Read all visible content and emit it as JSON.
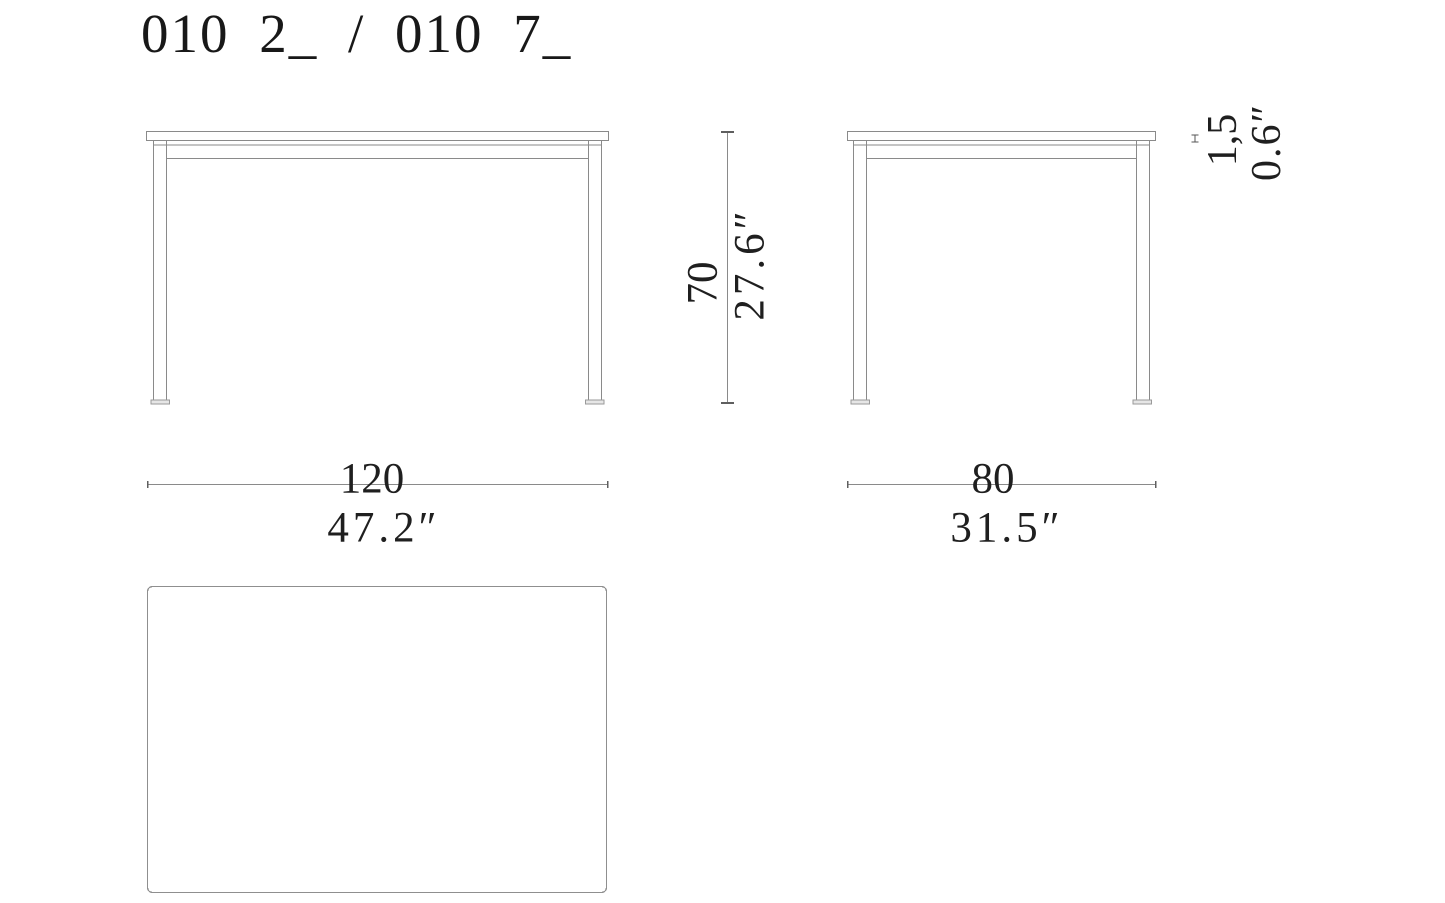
{
  "title": "010 2_ / 010 7_",
  "drawing_type": "furniture-dimension-drawing",
  "views": {
    "front": "front-view",
    "side": "side-view",
    "top": "top-plan-view"
  },
  "dimensions": {
    "height": {
      "cm": "70",
      "inches": "27.6″"
    },
    "width": {
      "cm": "120",
      "inches": "47.2″"
    },
    "depth": {
      "cm": "80",
      "inches": "31.5″"
    },
    "top_thickness": {
      "cm": "1,5",
      "inches": "0.6″"
    }
  },
  "colors": {
    "background": "#ffffff",
    "line": "#8a8a8a",
    "tick": "#5f5f5f",
    "text": "#1f1f1f"
  }
}
